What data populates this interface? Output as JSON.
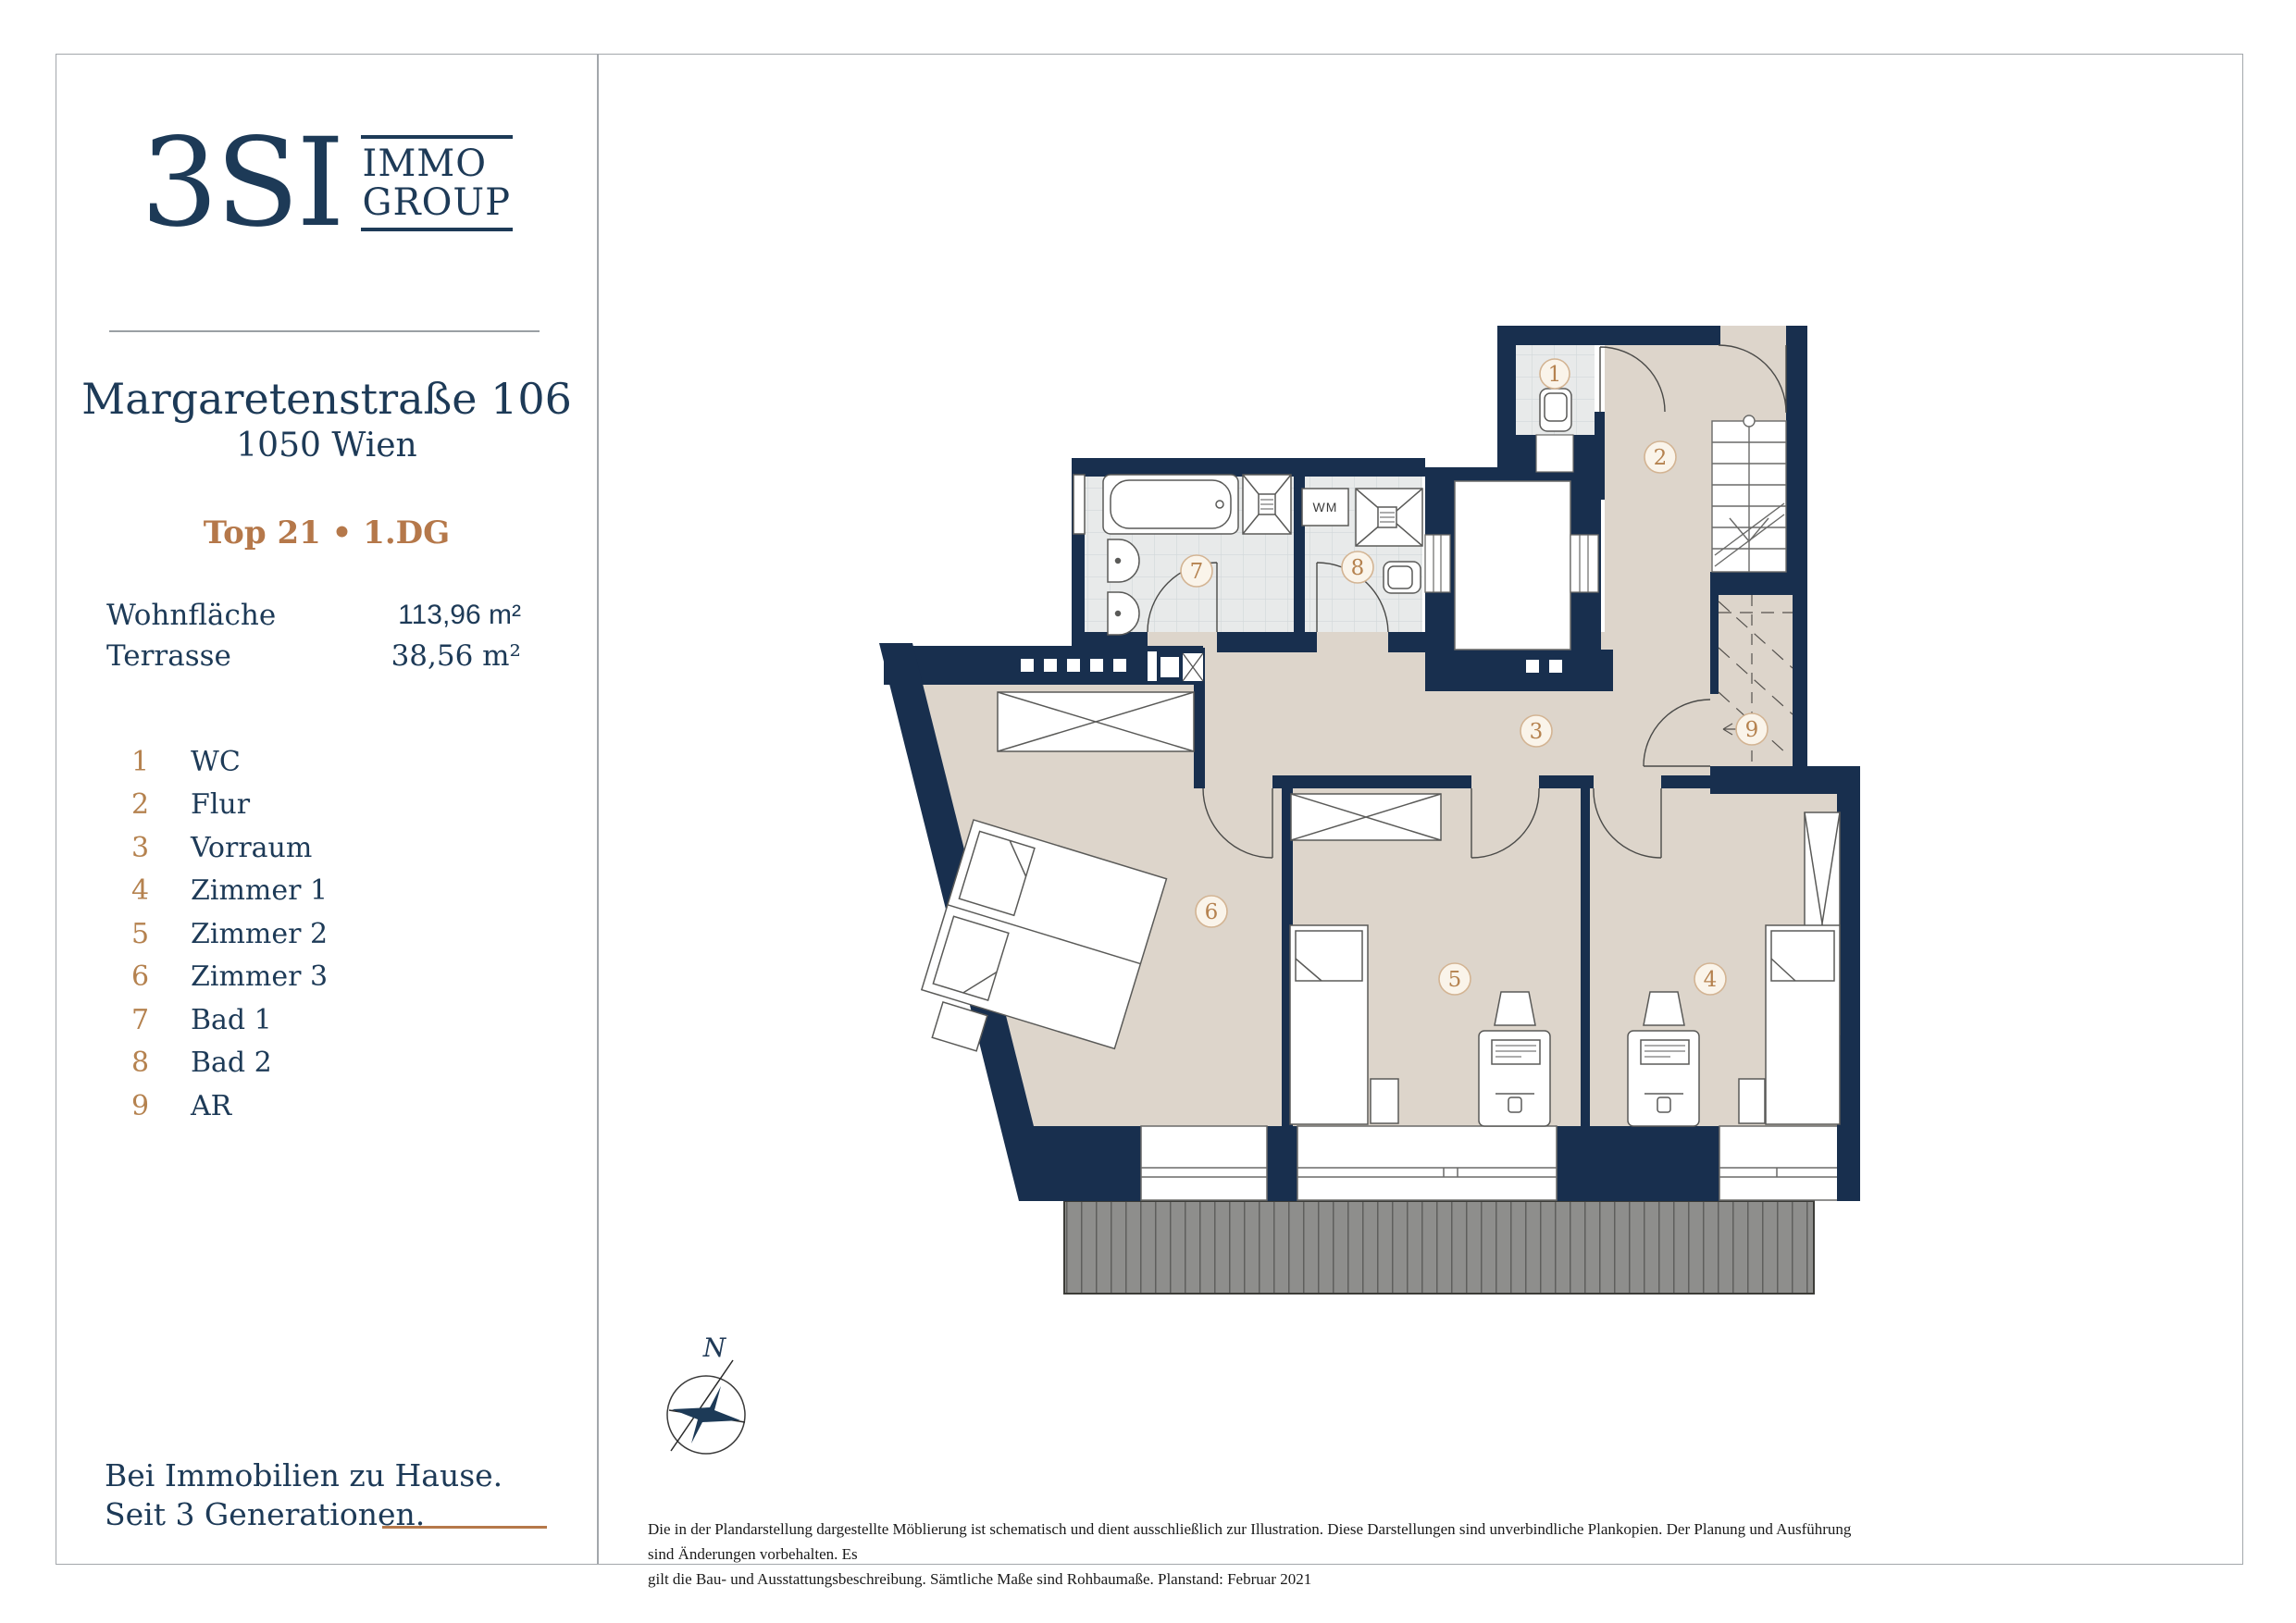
{
  "sidebar": {
    "logo": {
      "mark": "3SI",
      "name_line1": "IMMO",
      "name_line2": "GROUP"
    },
    "address": {
      "line1": "Margaretenstraße 106",
      "line2": "1050 Wien"
    },
    "unit": "Top 21 • 1.DG",
    "areas": [
      {
        "label": "Wohnfläche",
        "value": "113,96 m²"
      },
      {
        "label": "Terrasse",
        "value": "38,56 m²"
      }
    ]
  },
  "legend": [
    {
      "num": "1",
      "label": "WC"
    },
    {
      "num": "2",
      "label": "Flur"
    },
    {
      "num": "3",
      "label": "Vorraum"
    },
    {
      "num": "4",
      "label": "Zimmer 1"
    },
    {
      "num": "5",
      "label": "Zimmer 2"
    },
    {
      "num": "6",
      "label": "Zimmer 3"
    },
    {
      "num": "7",
      "label": "Bad 1"
    },
    {
      "num": "8",
      "label": "Bad 2"
    },
    {
      "num": "9",
      "label": "AR"
    }
  ],
  "plan": {
    "wm": "WM",
    "compass_n": "N"
  },
  "footer": {
    "line1": "Bei Immobilien zu Hause.",
    "line2": "Seit 3 Generationen."
  },
  "disclaimer": {
    "line1": "Die in der Plandarstellung dargestellte Möblierung ist schematisch und dient ausschließlich zur Illustration. Diese Darstellungen sind unverbindliche Plankopien. Der Planung und Ausführung sind Änderungen vorbehalten. Es",
    "line2": "gilt die Bau- und Ausstattungsbeschreibung. Sämtliche Maße sind Rohbaumaße. Planstand: Februar 2021"
  },
  "colors": {
    "navy_text": "#1d3a57",
    "wall_navy": "#182f4e",
    "accent_tan": "#b5784a",
    "number_tan": "#b5824f",
    "floor_beige": "#ddd5cb",
    "tile_gray": "#e8eaea",
    "terrace_gray": "#8e8e8c"
  }
}
